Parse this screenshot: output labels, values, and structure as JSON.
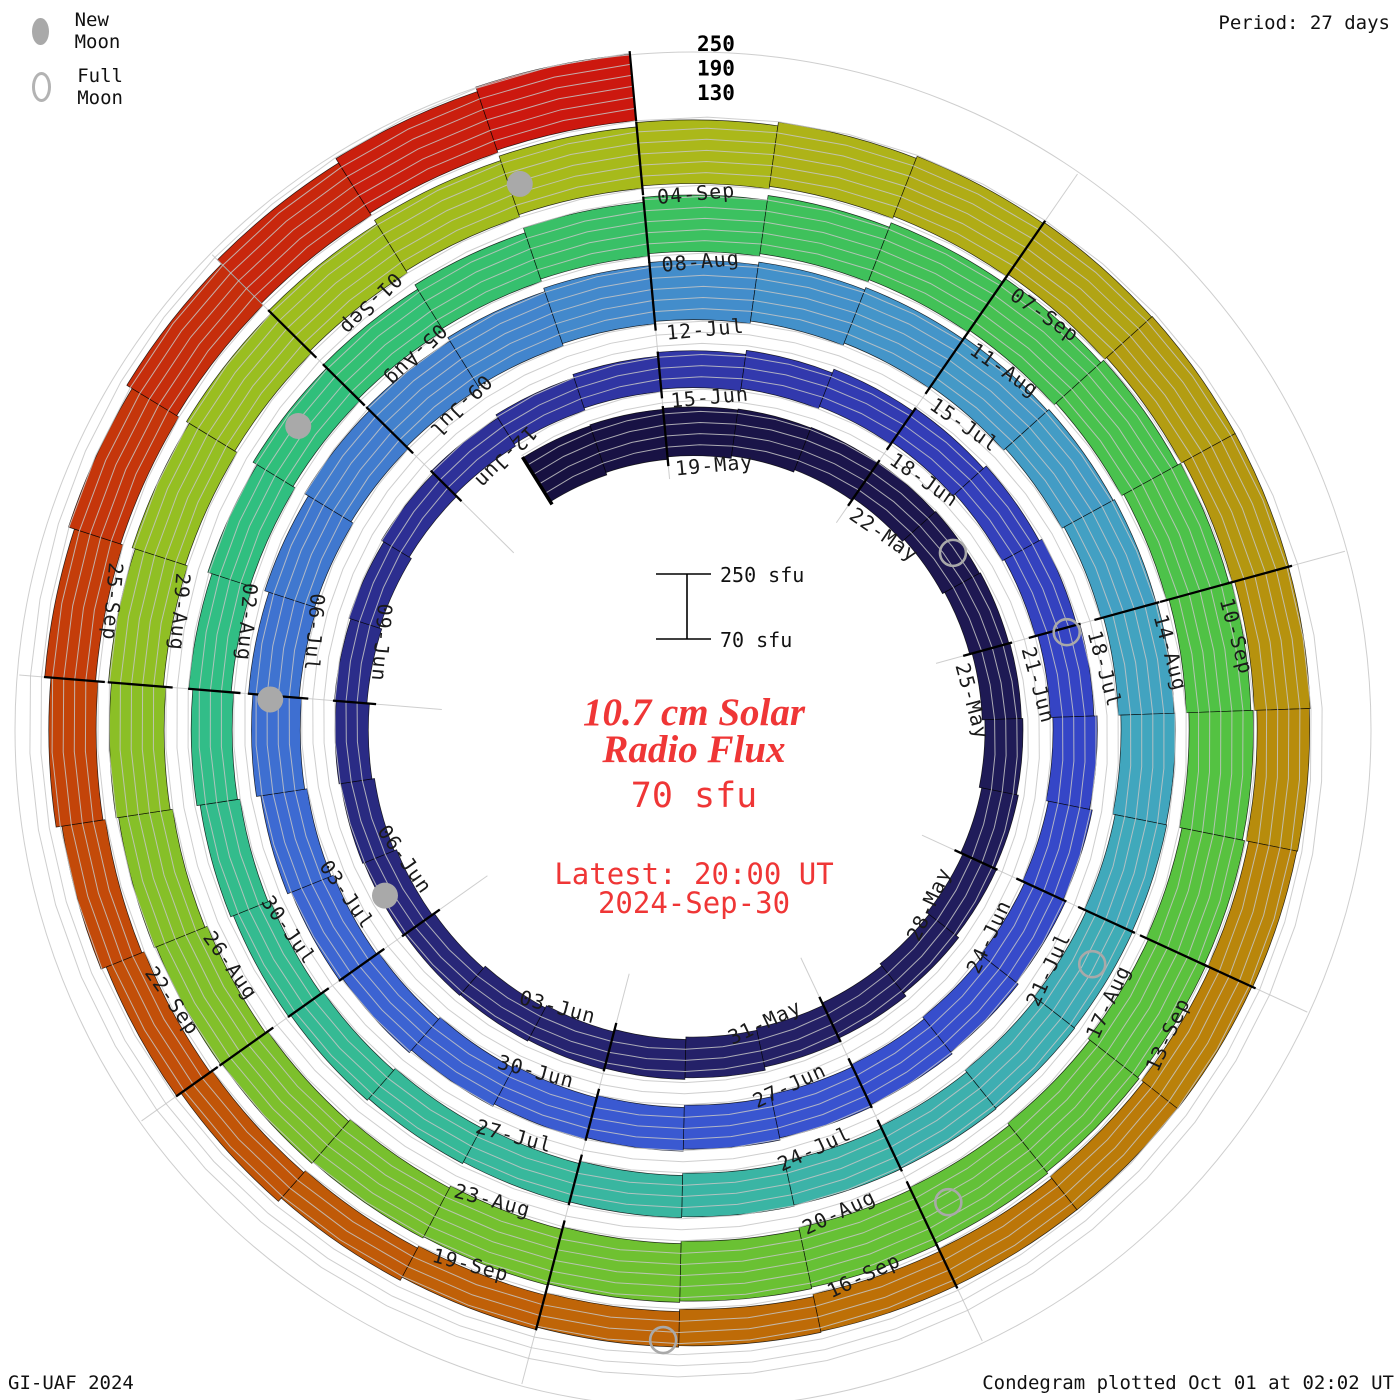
{
  "header": {
    "period_note": "Period: 27 days"
  },
  "legend": {
    "new_moon_label": "New Moon",
    "full_moon_label": "Full Moon"
  },
  "footer": {
    "left": "GI-UAF 2024",
    "right": "Condegram plotted Oct 01 at 02:02 UT"
  },
  "center": {
    "title_line1": "10.7 cm Solar",
    "title_line2": "Radio Flux",
    "current_value": "70 sfu",
    "latest_line1": "Latest: 20:00 UT",
    "latest_line2": "2024-Sep-30",
    "scale_top_label": "250 sfu",
    "scale_bottom_label": "70 sfu",
    "accent_color": "#ef3636"
  },
  "chart_data": {
    "type": "bar",
    "variant": "polar_spiral_condegram",
    "title": "10.7 cm Solar Radio Flux",
    "units": "sfu",
    "period_days": 27,
    "start_date": "2024-05-17",
    "end_date": "2024-09-30",
    "flux_axis_range": [
      70,
      250
    ],
    "gridline_levels": [
      100,
      130,
      160,
      190,
      220,
      250
    ],
    "end_scale_labels": [
      "250",
      "190",
      "130"
    ],
    "daily_flux": [
      210,
      206,
      202,
      198,
      193,
      188,
      184,
      180,
      176,
      173,
      171,
      170,
      172,
      175,
      178,
      180,
      178,
      175,
      172,
      168,
      165,
      162,
      160,
      158,
      157,
      158,
      160,
      163,
      166,
      170,
      174,
      178,
      181,
      184,
      186,
      188,
      190,
      191,
      192,
      192,
      191,
      190,
      189,
      188,
      187,
      188,
      190,
      193,
      197,
      202,
      207,
      212,
      217,
      221,
      225,
      228,
      230,
      231,
      231,
      230,
      228,
      225,
      221,
      217,
      212,
      207,
      202,
      197,
      192,
      188,
      184,
      181,
      179,
      178,
      178,
      179,
      181,
      185,
      190,
      196,
      202,
      209,
      216,
      223,
      229,
      235,
      240,
      243,
      245,
      245,
      244,
      243,
      241,
      239,
      237,
      235,
      232,
      229,
      226,
      223,
      221,
      219,
      218,
      218,
      219,
      221,
      223,
      226,
      231,
      237,
      242,
      245,
      244,
      241,
      236,
      229,
      221,
      212,
      203,
      194,
      186,
      179,
      173,
      169,
      166,
      166,
      169,
      174,
      181,
      189,
      198,
      208,
      218,
      228,
      237,
      244,
      250
    ],
    "date_labels": [
      {
        "t": 2,
        "label": "19-May"
      },
      {
        "t": 5,
        "label": "22-May"
      },
      {
        "t": 8,
        "label": "25-May"
      },
      {
        "t": 11,
        "label": "28-May"
      },
      {
        "t": 14,
        "label": "31-May"
      },
      {
        "t": 17,
        "label": "03-Jun"
      },
      {
        "t": 20,
        "label": "06-Jun"
      },
      {
        "t": 23,
        "label": "09-Jun"
      },
      {
        "t": 26,
        "label": "12-Jun"
      },
      {
        "t": 29,
        "label": "15-Jun"
      },
      {
        "t": 32,
        "label": "18-Jun"
      },
      {
        "t": 35,
        "label": "21-Jun"
      },
      {
        "t": 38,
        "label": "24-Jun"
      },
      {
        "t": 41,
        "label": "27-Jun"
      },
      {
        "t": 44,
        "label": "30-Jun"
      },
      {
        "t": 47,
        "label": "03-Jul"
      },
      {
        "t": 50,
        "label": "06-Jul"
      },
      {
        "t": 53,
        "label": "09-Jul"
      },
      {
        "t": 56,
        "label": "12-Jul"
      },
      {
        "t": 59,
        "label": "15-Jul"
      },
      {
        "t": 62,
        "label": "18-Jul"
      },
      {
        "t": 65,
        "label": "21-Jul"
      },
      {
        "t": 68,
        "label": "24-Jul"
      },
      {
        "t": 71,
        "label": "27-Jul"
      },
      {
        "t": 74,
        "label": "30-Jul"
      },
      {
        "t": 77,
        "label": "02-Aug"
      },
      {
        "t": 80,
        "label": "05-Aug"
      },
      {
        "t": 83,
        "label": "08-Aug"
      },
      {
        "t": 86,
        "label": "11-Aug"
      },
      {
        "t": 89,
        "label": "14-Aug"
      },
      {
        "t": 92,
        "label": "17-Aug"
      },
      {
        "t": 95,
        "label": "20-Aug"
      },
      {
        "t": 98,
        "label": "23-Aug"
      },
      {
        "t": 101,
        "label": "26-Aug"
      },
      {
        "t": 104,
        "label": "29-Aug"
      },
      {
        "t": 107,
        "label": "01-Sep"
      },
      {
        "t": 110,
        "label": "04-Sep"
      },
      {
        "t": 113,
        "label": "07-Sep"
      },
      {
        "t": 116,
        "label": "10-Sep"
      },
      {
        "t": 119,
        "label": "13-Sep"
      },
      {
        "t": 122,
        "label": "16-Sep"
      },
      {
        "t": 125,
        "label": "19-Sep"
      },
      {
        "t": 128,
        "label": "22-Sep"
      },
      {
        "t": 131,
        "label": "25-Sep"
      }
    ],
    "moons": {
      "new": [
        {
          "date": "06-Jun",
          "t": 20.53
        },
        {
          "date": "05-Jul",
          "t": 49.96
        },
        {
          "date": "04-Aug",
          "t": 79.47
        },
        {
          "date": "03-Sep",
          "t": 109.08
        }
      ],
      "full": [
        {
          "date": "23-May",
          "t": 6.58
        },
        {
          "date": "21-Jun",
          "t": 35.05
        },
        {
          "date": "21-Jul",
          "t": 65.43
        },
        {
          "date": "19-Aug",
          "t": 94.77
        },
        {
          "date": "18-Sep",
          "t": 124.11
        }
      ]
    },
    "colormap": [
      [
        0,
        "#171040"
      ],
      [
        8,
        "#1e1953"
      ],
      [
        15,
        "#242066"
      ],
      [
        21,
        "#29297e"
      ],
      [
        26,
        "#2d3096"
      ],
      [
        31,
        "#323ab0"
      ],
      [
        36,
        "#3545c6"
      ],
      [
        42,
        "#3954d0"
      ],
      [
        48,
        "#3d68d2"
      ],
      [
        54,
        "#4283cd"
      ],
      [
        59,
        "#4497c8"
      ],
      [
        64,
        "#41a8bd"
      ],
      [
        69,
        "#3bb4a6"
      ],
      [
        74,
        "#34bb92"
      ],
      [
        79,
        "#2fbf7e"
      ],
      [
        84,
        "#3dc15d"
      ],
      [
        90,
        "#52c243"
      ],
      [
        96,
        "#68c134"
      ],
      [
        102,
        "#84c029"
      ],
      [
        107,
        "#9cbe1f"
      ],
      [
        111,
        "#adb719"
      ],
      [
        114,
        "#b2a013"
      ],
      [
        118,
        "#b8890b"
      ],
      [
        122,
        "#bc7307"
      ],
      [
        126,
        "#c05d08"
      ],
      [
        130,
        "#c34709"
      ],
      [
        133,
        "#c5320b"
      ],
      [
        137,
        "#cd1410"
      ]
    ],
    "style": {
      "grid_color": "#c5c5c5",
      "tick_color": "#000000",
      "label_color": "#1a1a1a",
      "moon_gray": "#a9a9a9"
    }
  }
}
